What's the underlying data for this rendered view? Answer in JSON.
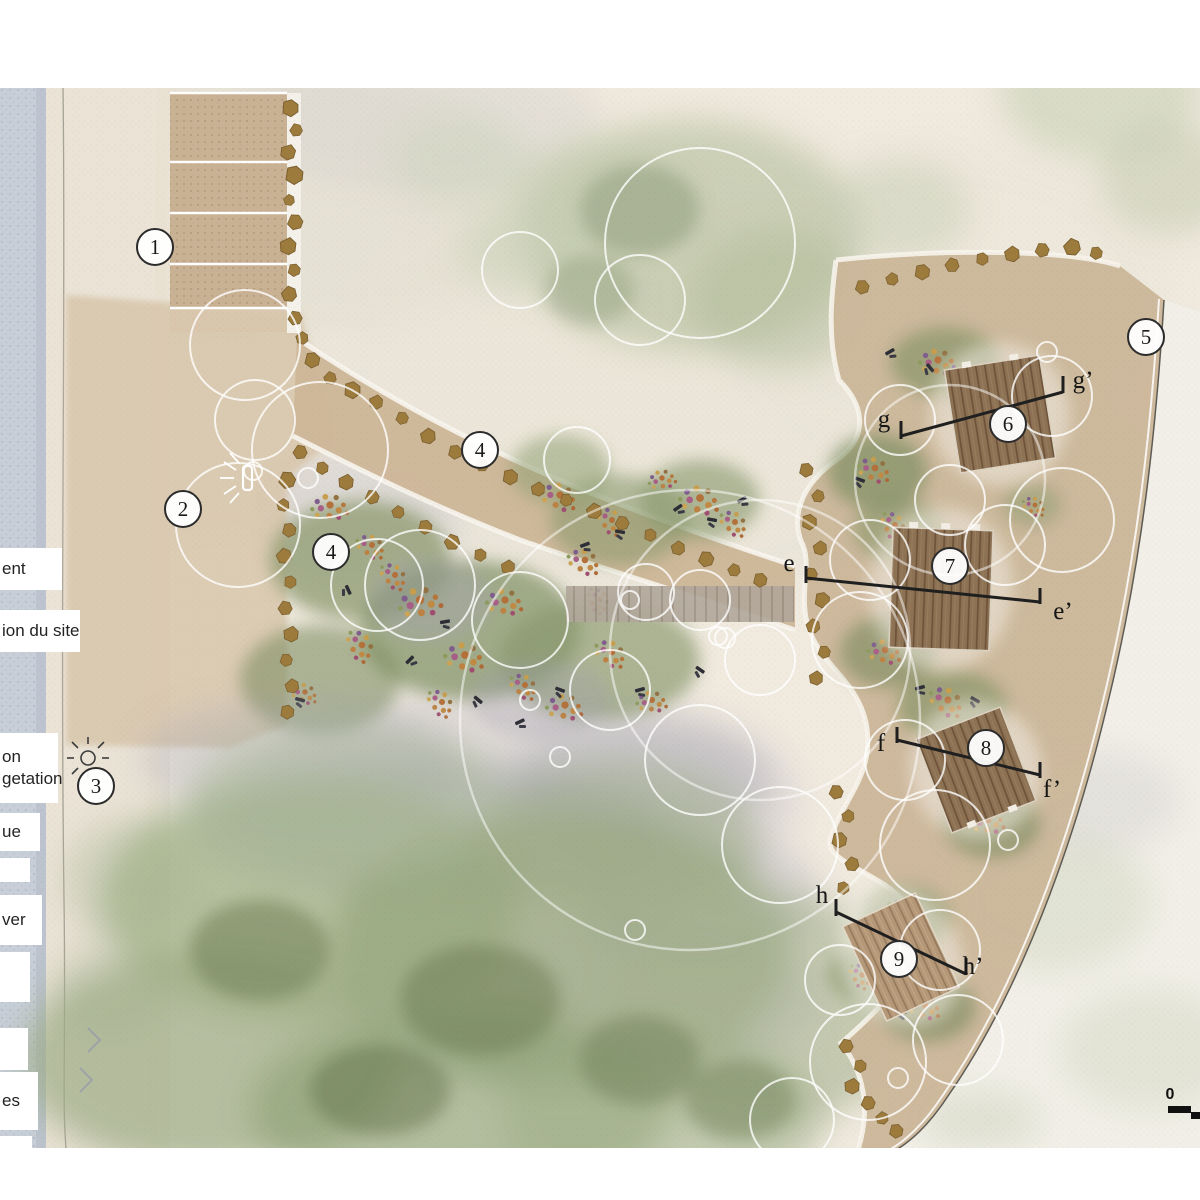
{
  "title": "landscape site plan",
  "legend": {
    "items": [
      "ent",
      "ion du site",
      "on",
      "getation",
      "ue",
      "ver",
      "es"
    ]
  },
  "markers": [
    {
      "label": "1"
    },
    {
      "label": "2"
    },
    {
      "label": "3"
    },
    {
      "label": "4"
    },
    {
      "label": "4"
    },
    {
      "label": "5"
    },
    {
      "label": "6"
    },
    {
      "label": "7"
    },
    {
      "label": "8"
    },
    {
      "label": "9"
    }
  ],
  "section_labels": [
    {
      "label": "g"
    },
    {
      "label": "g’"
    },
    {
      "label": "e"
    },
    {
      "label": "e’"
    },
    {
      "label": "f"
    },
    {
      "label": "f’"
    },
    {
      "label": "h"
    },
    {
      "label": "h’"
    }
  ],
  "scale_bar": {
    "zero": "0"
  },
  "icons": {
    "sun": "sun-with-rays",
    "viewpoint": "illuminated-bench-marker",
    "chevrons": "shore-direction-chevrons"
  },
  "colors": {
    "water": "#c8cfd9",
    "beach_sand": "#eae3d6",
    "terrain_paper": "#f0eadf",
    "path_tan": "#cdb698",
    "wood_deck": "#8d7254",
    "wood_deck_light": "#b59878",
    "stone": "#9c7b3c",
    "vegetation_green": "#94a47c",
    "section_line": "#1f1f1f"
  }
}
